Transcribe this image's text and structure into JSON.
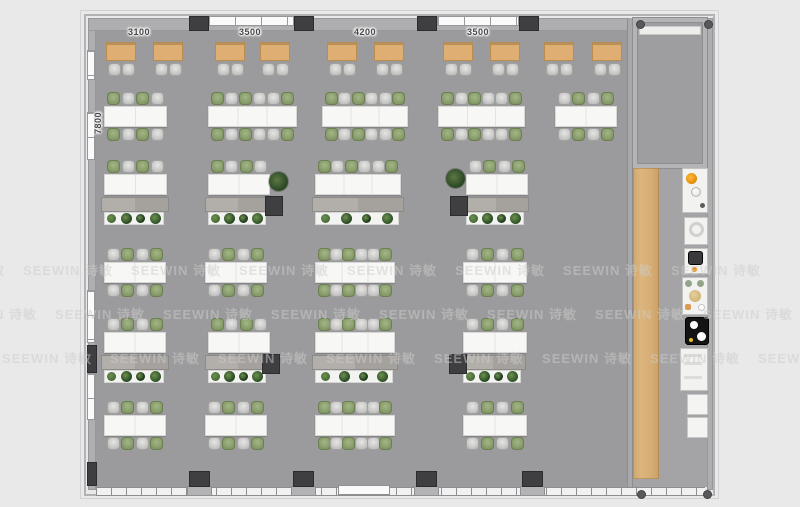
{
  "scene": {
    "kind": "office-floor-plan-render",
    "width": 800,
    "height": 507
  },
  "dimensions": {
    "top_labels": [
      {
        "text": "3100",
        "x": 139,
        "y": 27
      },
      {
        "text": "3500",
        "x": 250,
        "y": 27
      },
      {
        "text": "4200",
        "x": 365,
        "y": 27
      },
      {
        "text": "3500",
        "x": 478,
        "y": 27
      }
    ],
    "left_label": {
      "text": "7800",
      "x": 99,
      "y": 117
    }
  },
  "watermark": {
    "text": "SEEWIN 诗敏",
    "step": 108,
    "rows": [
      {
        "y": 268,
        "offset": 68
      },
      {
        "y": 312,
        "offset": -8
      },
      {
        "y": 356,
        "offset": 47
      }
    ]
  },
  "palette": {
    "background": "#e9e9ea",
    "floor": "#9b9b9d",
    "floor_right": "#a4a4a6",
    "wall": "#aeaeb0",
    "pillar": "#3f3f42",
    "desk": "#f7f7f5",
    "table_wood": "#dfae72",
    "chair_green": "#8ca06f",
    "chair_gray": "#cbcbc9",
    "cabinet": "#aba8a3",
    "planter": "#f3f3f1",
    "plant_green": "#2f4c28",
    "wood_strip": "#d6ad74",
    "fixture_orange": "#e8920e",
    "watermark_gray": "#cdcdcd"
  },
  "architecture": {
    "outer_frame": {
      "x": 80,
      "y": 10,
      "w": 639,
      "h": 489
    },
    "building": {
      "x": 84,
      "y": 14,
      "w": 631,
      "h": 482
    },
    "left_wall": {
      "x": 88,
      "y": 18,
      "w": 8,
      "h": 472
    },
    "top_wall": {
      "x": 88,
      "y": 18,
      "w": 545,
      "h": 13
    },
    "right_wall": {
      "x": 707,
      "y": 18,
      "w": 6,
      "h": 472
    },
    "bottom_wall_y": 487,
    "floor_main": {
      "x": 96,
      "y": 31,
      "w": 531,
      "h": 456
    },
    "floor_right": {
      "x": 633,
      "y": 164,
      "w": 74,
      "h": 323
    },
    "divider_wall": {
      "x": 627,
      "y": 18,
      "w": 6,
      "h": 472
    },
    "room": {
      "x": 633,
      "y": 18,
      "w": 74,
      "h": 150,
      "band": {
        "x": 639,
        "y": 26,
        "w": 62,
        "h": 9
      }
    },
    "wood_strip": {
      "x": 633,
      "y": 168,
      "w": 26,
      "h": 311
    },
    "top_windows": [
      {
        "x": 208,
        "w": 86
      },
      {
        "x": 437,
        "w": 82
      }
    ],
    "top_pillars": [
      189,
      294,
      417,
      519
    ],
    "bottom_pillars": [
      189,
      293,
      416,
      522
    ],
    "left_windows": [
      {
        "y": 50,
        "h": 30
      },
      {
        "y": 112,
        "h": 48
      },
      {
        "y": 290,
        "h": 53
      },
      {
        "y": 373,
        "h": 47
      }
    ],
    "left_pillars": [
      {
        "y": 345,
        "h": 28
      },
      {
        "y": 462,
        "h": 24
      }
    ],
    "entry_door": {
      "x": 338,
      "y": 485,
      "w": 52,
      "h": 10
    },
    "corner_dots": [
      [
        636,
        20
      ],
      [
        704,
        20
      ],
      [
        637,
        490
      ],
      [
        703,
        490
      ]
    ]
  },
  "furniture": {
    "chair_patterns": {
      "a": [
        "green",
        "gray",
        "green",
        "gray"
      ],
      "b": [
        "gray",
        "green",
        "gray",
        "green"
      ],
      "six": [
        "green",
        "gray",
        "green",
        "gray",
        "gray",
        "green"
      ]
    },
    "top_tables": {
      "y": 42,
      "w": 30,
      "h": 19,
      "chair_y": 63,
      "xs": [
        106,
        153,
        215,
        260,
        327,
        374,
        443,
        490,
        544,
        592
      ]
    },
    "cluster_rows": [
      {
        "name": "workstation-row-1",
        "type": "double",
        "desk_y": 106,
        "desk_h": 21,
        "clusters": [
          {
            "x": 104,
            "w": 63,
            "seats": 4,
            "pattern": "a"
          },
          {
            "x": 208,
            "w": 89,
            "seats": 6,
            "pattern": "six"
          },
          {
            "x": 322,
            "w": 86,
            "seats": 6,
            "pattern": "six"
          },
          {
            "x": 438,
            "w": 87,
            "seats": 6,
            "pattern": "six"
          },
          {
            "x": 555,
            "w": 62,
            "seats": 4,
            "pattern": "b"
          }
        ]
      },
      {
        "name": "workstation-row-2",
        "type": "single",
        "desk_y": 174,
        "desk_h": 21,
        "clusters": [
          {
            "x": 104,
            "w": 63,
            "seats": 4,
            "pattern": "a"
          },
          {
            "x": 208,
            "w": 62,
            "seats": 4,
            "pattern": "a"
          },
          {
            "x": 315,
            "w": 86,
            "seats": 6,
            "pattern": "six"
          },
          {
            "x": 466,
            "w": 62,
            "seats": 4,
            "pattern": "b"
          }
        ],
        "cabinet_y": 197,
        "cabinets": [
          {
            "x": 101,
            "w": 68
          },
          {
            "x": 205,
            "w": 66
          },
          {
            "x": 312,
            "w": 92
          },
          {
            "x": 463,
            "w": 66
          }
        ],
        "pillars": [
          265,
          450
        ],
        "plants": [
          {
            "x": 269,
            "y": 172
          },
          {
            "x": 446,
            "y": 169
          }
        ]
      },
      {
        "name": "workstation-row-3",
        "type": "double",
        "desk_y": 262,
        "desk_h": 21,
        "clusters": [
          {
            "x": 104,
            "w": 62,
            "seats": 4,
            "pattern": "b"
          },
          {
            "x": 205,
            "w": 62,
            "seats": 4,
            "pattern": "b"
          },
          {
            "x": 315,
            "w": 80,
            "seats": 6,
            "pattern": "six"
          },
          {
            "x": 463,
            "w": 64,
            "seats": 4,
            "pattern": "b"
          }
        ]
      },
      {
        "name": "workstation-row-4",
        "type": "single",
        "desk_y": 332,
        "desk_h": 21,
        "clusters": [
          {
            "x": 104,
            "w": 62,
            "seats": 4,
            "pattern": "b"
          },
          {
            "x": 208,
            "w": 62,
            "seats": 4,
            "pattern": "a"
          },
          {
            "x": 315,
            "w": 80,
            "seats": 6,
            "pattern": "six"
          },
          {
            "x": 463,
            "w": 64,
            "seats": 4,
            "pattern": "b"
          }
        ],
        "cabinet_y": 355,
        "cabinets": [
          {
            "x": 101,
            "w": 68
          },
          {
            "x": 205,
            "w": 66
          },
          {
            "x": 312,
            "w": 86
          },
          {
            "x": 460,
            "w": 66
          }
        ],
        "pillars": [
          262,
          449
        ],
        "plants": []
      },
      {
        "name": "workstation-row-5",
        "type": "double",
        "desk_y": 415,
        "desk_h": 21,
        "clusters": [
          {
            "x": 104,
            "w": 62,
            "seats": 4,
            "pattern": "b"
          },
          {
            "x": 205,
            "w": 62,
            "seats": 4,
            "pattern": "b"
          },
          {
            "x": 315,
            "w": 80,
            "seats": 6,
            "pattern": "six"
          },
          {
            "x": 463,
            "w": 64,
            "seats": 4,
            "pattern": "b"
          }
        ]
      }
    ],
    "planter_plant_colors": [
      "#4a7039",
      "#2d4f28",
      "#1f3d1e",
      "#35592c"
    ],
    "pantry_fixtures": [
      {
        "type": "counter",
        "x": 682,
        "y": 168,
        "w": 26,
        "h": 45
      },
      {
        "type": "toilet",
        "x": 684,
        "y": 217,
        "w": 24,
        "h": 28
      },
      {
        "type": "control",
        "x": 684,
        "y": 248,
        "w": 24,
        "h": 26
      },
      {
        "type": "shelf",
        "x": 682,
        "y": 277,
        "w": 26,
        "h": 38
      },
      {
        "type": "appliance",
        "x": 685,
        "y": 317,
        "w": 24,
        "h": 28
      },
      {
        "type": "panel",
        "x": 680,
        "y": 348,
        "w": 28,
        "h": 43
      },
      {
        "type": "cabinet",
        "x": 687,
        "y": 394,
        "w": 21,
        "h": 21
      },
      {
        "type": "cabinet",
        "x": 687,
        "y": 417,
        "w": 21,
        "h": 21
      }
    ]
  }
}
